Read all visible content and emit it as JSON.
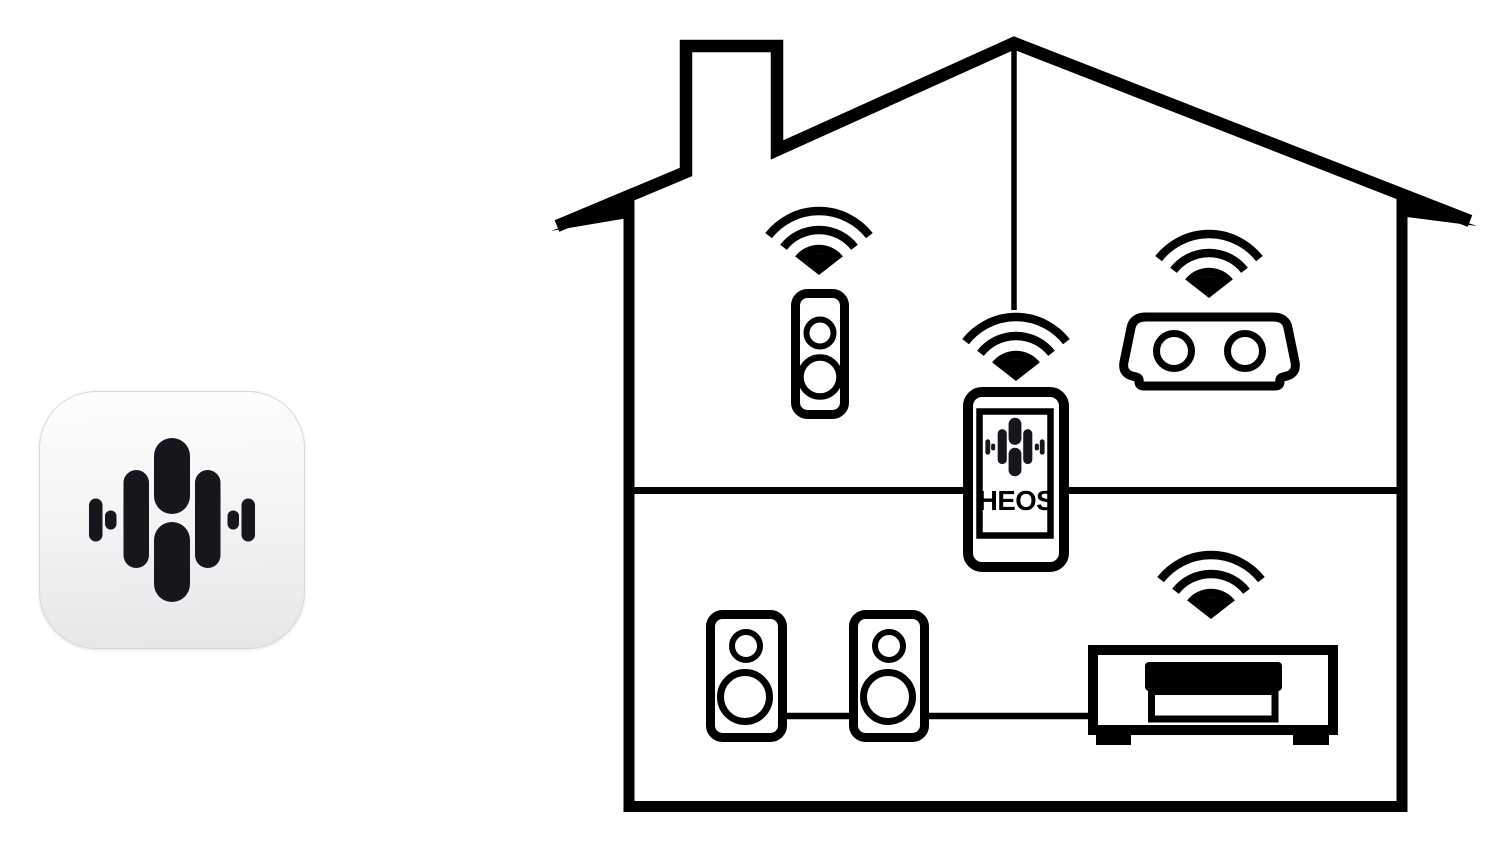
{
  "canvas": {
    "background": "#ffffff",
    "width": 1506,
    "height": 850
  },
  "app_icon": {
    "name": "HEOS app icon",
    "icon": "heos-logo-icon",
    "bg_top": "#fdfdfd",
    "bg_bottom": "#e6e6e9",
    "logo_color": "#16161d",
    "border_color": "#d8d8db"
  },
  "house": {
    "line_color": "#000000",
    "fill_color": "#ffffff",
    "phone": {
      "screen_label": "HEOS",
      "logo_icon": "heos-logo-icon",
      "wifi_icon": "wifi-icon"
    },
    "devices": [
      {
        "name": "wireless speaker",
        "icon": "speaker-icon",
        "wifi": true
      },
      {
        "name": "portable speaker",
        "icon": "portable-speaker-icon",
        "wifi": true
      },
      {
        "name": "HEOS smartphone",
        "icon": "smartphone-icon",
        "wifi": true
      },
      {
        "name": "bookshelf speaker left",
        "icon": "speaker-icon",
        "wifi": false
      },
      {
        "name": "bookshelf speaker right",
        "icon": "speaker-icon",
        "wifi": false
      },
      {
        "name": "AV receiver",
        "icon": "receiver-icon",
        "wifi": true
      }
    ]
  }
}
